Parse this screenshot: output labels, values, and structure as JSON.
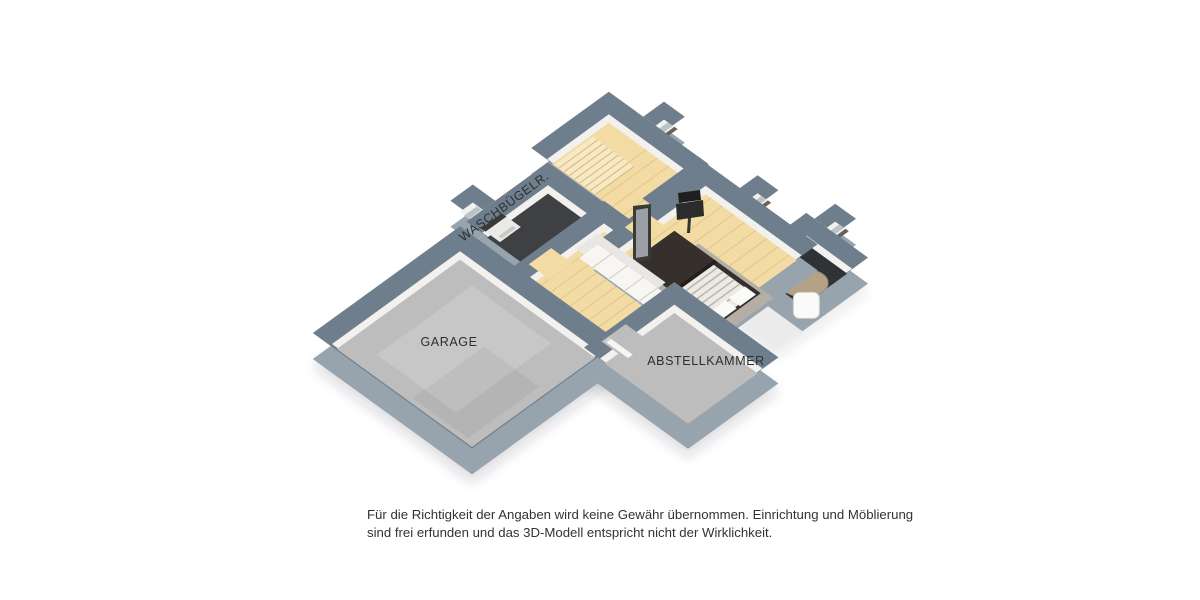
{
  "image_type": "3d-floorplan-render",
  "floor": {
    "labels": {
      "garage": "GARAGE",
      "storage": "ABSTELLKAMMER",
      "laundry": "WASCHBÜGELR."
    }
  },
  "disclaimer": {
    "line1": "Für die Richtigkeit der Angaben wird keine Gewähr übernommen. Einrichtung und Möblierung",
    "line2": "sind frei erfunden und das 3D-Modell entspricht nicht der Wirklichkeit."
  },
  "colors": {
    "background": "#ffffff",
    "wall_cap": "#6f7e8c",
    "wall_side": "#97a4ae",
    "wall_inner": "#f2f1ed",
    "floor_wood": "#f3dca4",
    "floor_wood_line": "#d9ba84",
    "stair_tread": "#f7e9c4",
    "stair_edge": "#d8bd8a",
    "floor_concrete": "#bdbdbd",
    "floor_dark": "#3e4043",
    "floor_bath": "#303335",
    "rug_gray": "#b5aea5",
    "rug_round": "#b3a287",
    "bed_frame": "#35302b",
    "bed_linen": "#eceae4",
    "label_text": "#2e2e2e",
    "disclaimer_text": "#333333",
    "glass": "#b9c3c8",
    "sill": "#6a6157"
  }
}
